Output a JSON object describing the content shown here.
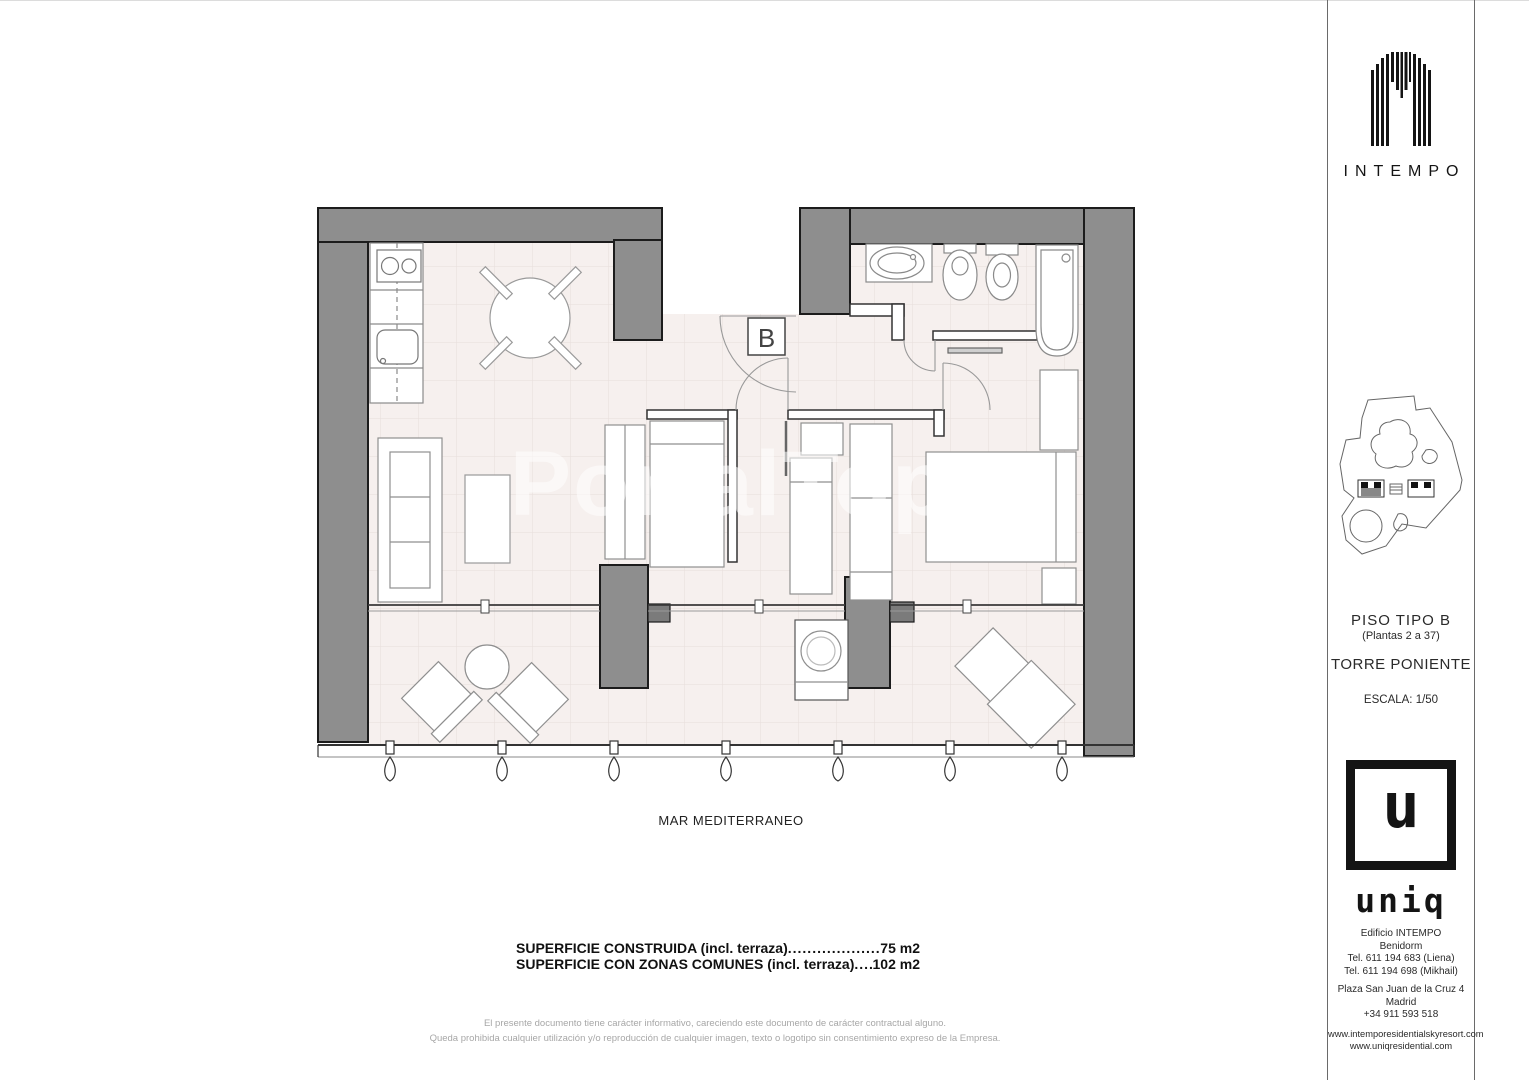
{
  "page": {
    "width": 1529,
    "height": 1080
  },
  "colors": {
    "wall_gray": "#8e8e8e",
    "floor_tint": "#f6f0ee",
    "ink": "#1a1a1a"
  },
  "watermark": {
    "text": "PortalTop"
  },
  "plan": {
    "unit_label": "B",
    "sea_label": "MAR MEDITERRANEO",
    "areas": [
      {
        "label": "SUPERFICIE CONSTRUIDA (incl. terraza) ",
        "dots": "......................................................................................",
        "value": "75 m2"
      },
      {
        "label": "SUPERFICIE CON ZONAS COMUNES (incl. terraza)",
        "dots": "......................................................................................",
        "value": "102 m2"
      }
    ]
  },
  "disclaimer": {
    "line1": "El presente documento tiene carácter informativo, careciendo este documento de carácter contractual alguno.",
    "line2": "Queda prohibida cualquier utilización y/o reproducción de cualquier imagen, texto o logotipo sin consentimiento expreso de la Empresa."
  },
  "sidebar": {
    "brand": {
      "name": "INTEMPO"
    },
    "unit": {
      "title": "PISO TIPO B",
      "floors": "(Plantas 2 a 37)",
      "tower": "TORRE PONIENTE",
      "scale": "ESCALA: 1/50"
    },
    "agency": {
      "logo_letter": "u",
      "logo_name": "uniq",
      "building": "Edificio INTEMPO",
      "city1": "Benidorm",
      "tel1": "Tel. 611 194 683 (Liena)",
      "tel2": "Tel. 611 194 698 (Mikhail)",
      "address": "Plaza San Juan de la Cruz 4",
      "city2": "Madrid",
      "tel3": "+34 911 593 518",
      "web1": "www.intemporesidentialskyresort.com",
      "web2": "www.uniqresidential.com"
    }
  }
}
